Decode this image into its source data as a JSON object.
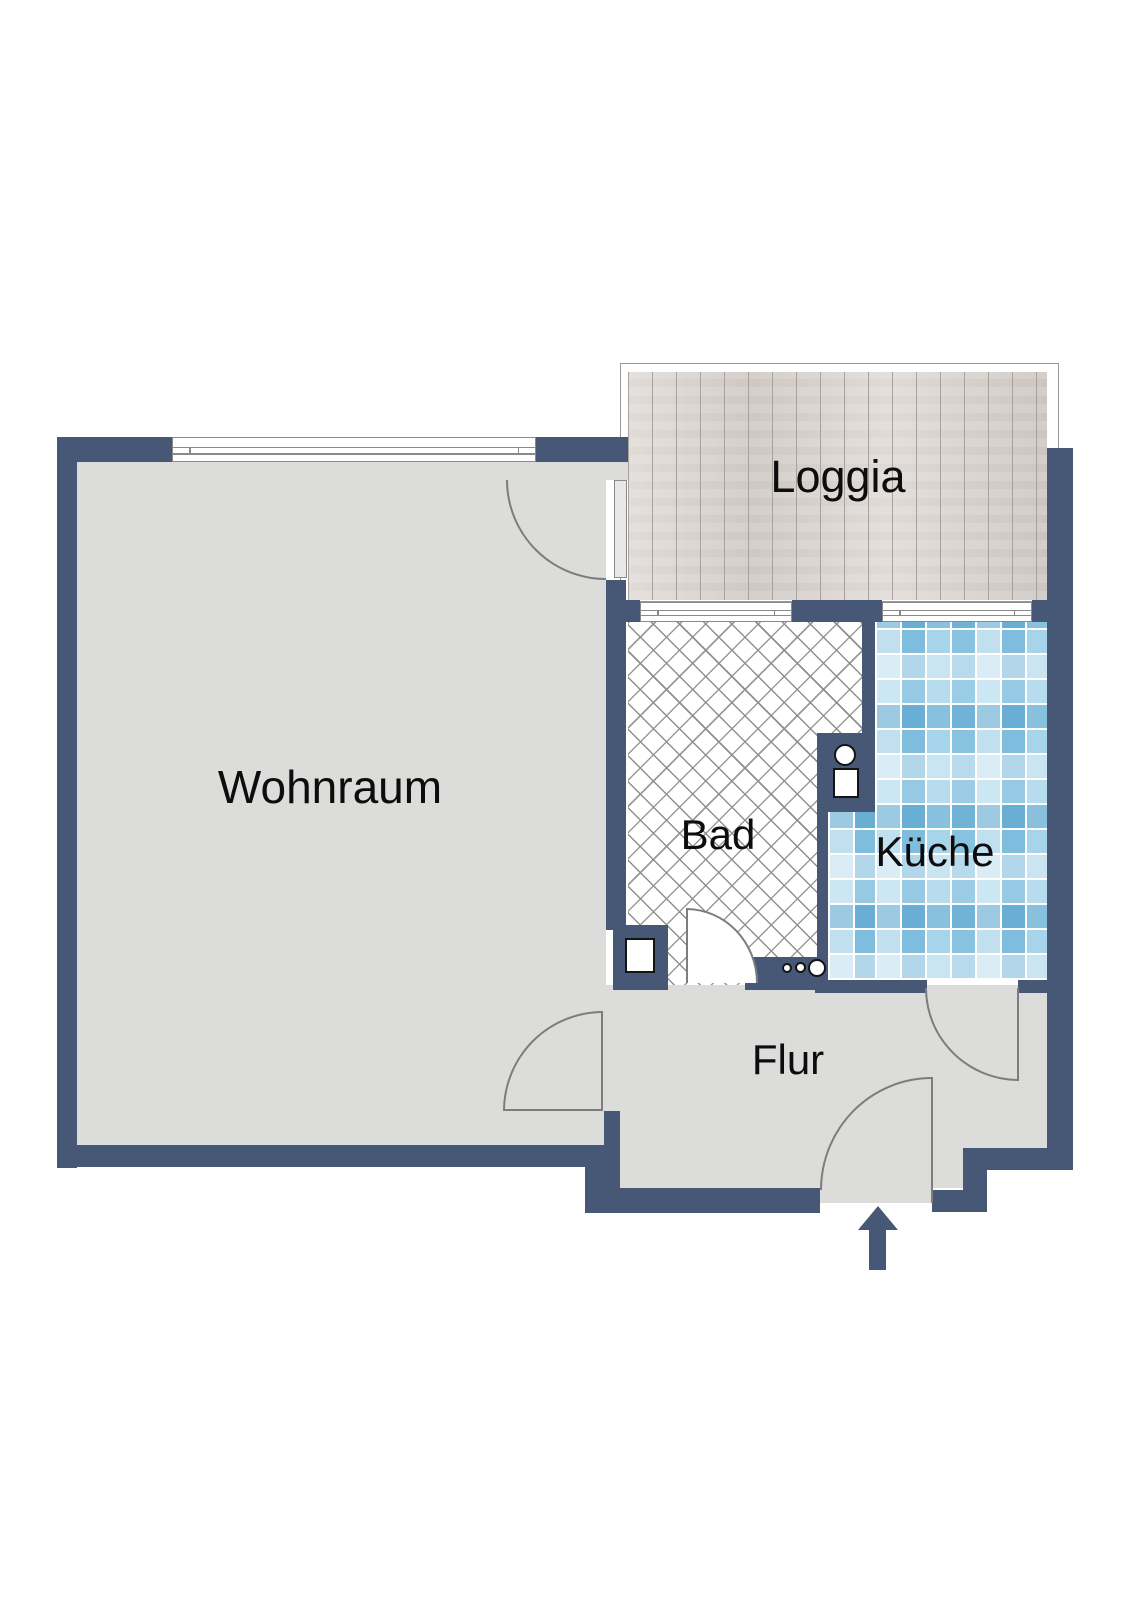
{
  "plan": {
    "type": "apartment-floor-plan",
    "rooms": {
      "wohnraum": {
        "label": "Wohnraum"
      },
      "loggia": {
        "label": "Loggia"
      },
      "bad": {
        "label": "Bad"
      },
      "kueche": {
        "label": "Küche"
      },
      "flur": {
        "label": "Flur"
      }
    },
    "features": {
      "entrance_arrow": "entry-direction-up",
      "doors": [
        "loggia-door",
        "bad-door",
        "kueche-door",
        "wohnraum-door",
        "entrance-door"
      ],
      "windows": [
        "wohnraum-window",
        "bad-window",
        "kueche-window"
      ],
      "fixtures": [
        "shaft-symbol-circle",
        "shaft-symbol-square",
        "bad-shaft-square",
        "three-circles"
      ]
    }
  },
  "colors": {
    "wall": "#475877",
    "floor": "#dcdcda",
    "bad_floor": "#ffffff",
    "hatch_line": "#8f8f8f",
    "tile_base": "#9fd0e8",
    "grout": "#ffffff",
    "wood": "#d7d0cb",
    "wood_line": "#a8a19c",
    "window_frame": "#8a8a8a",
    "door_stroke": "#7d7d7d",
    "loggia_outline": "#9a9a9a",
    "label_text": "#0d0d0d"
  }
}
